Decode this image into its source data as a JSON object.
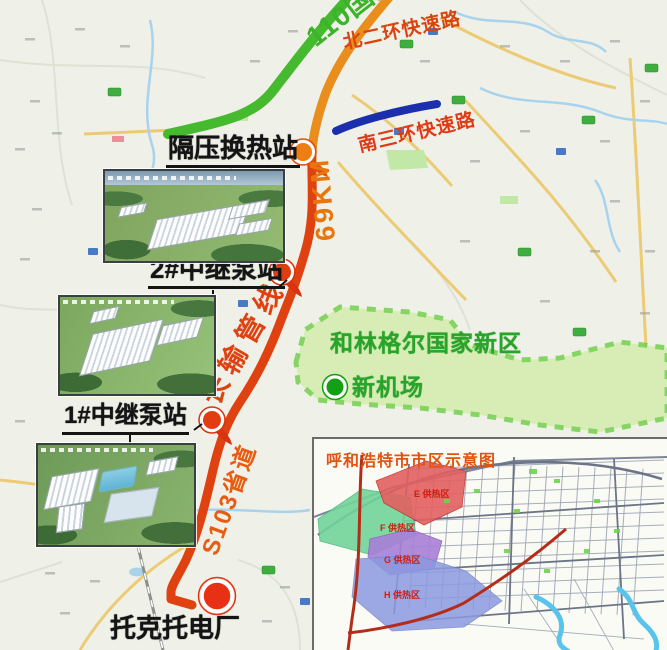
{
  "map": {
    "roads": {
      "g110": {
        "label": "110国道",
        "color": "#3cb32a",
        "road_color": "#46ba2e"
      },
      "north_ring": {
        "label": "北二环快速路",
        "color": "#d9430e"
      },
      "south_ring": {
        "label": "南三环快速路",
        "color": "#e03914",
        "road_color": "#1b2fae"
      },
      "s103": {
        "label": "S103省道",
        "color": "#e85c10"
      }
    },
    "pipeline": {
      "label": "长输管线",
      "length_label": "69KM",
      "color": "#df4210",
      "top_color": "#e98d1c",
      "km_color": "#e8760a"
    },
    "stations": [
      {
        "label": "隔压换热站"
      },
      {
        "label": "2#中继泵站"
      },
      {
        "label": "1#中继泵站"
      }
    ],
    "plant": {
      "label": "托克托电厂",
      "marker_color": "#e83014"
    },
    "new_area": {
      "label": "和林格尔国家新区",
      "airport_label": "新机场",
      "fill": "#d3edaa",
      "border": "#6ccd44",
      "text_color": "#2aa32a",
      "airport_marker_color": "#14a014"
    }
  },
  "inset": {
    "title": "呼和浩特市市区示意图",
    "title_color": "#e25310",
    "zones": [
      {
        "label": "E 供热区",
        "color": "#e26060"
      },
      {
        "label": "F 供热区",
        "color": "#72d49a"
      },
      {
        "label": "G 供热区",
        "color": "#a77fd8"
      },
      {
        "label": "H 供热区",
        "color": "#8b9ae0"
      }
    ]
  }
}
